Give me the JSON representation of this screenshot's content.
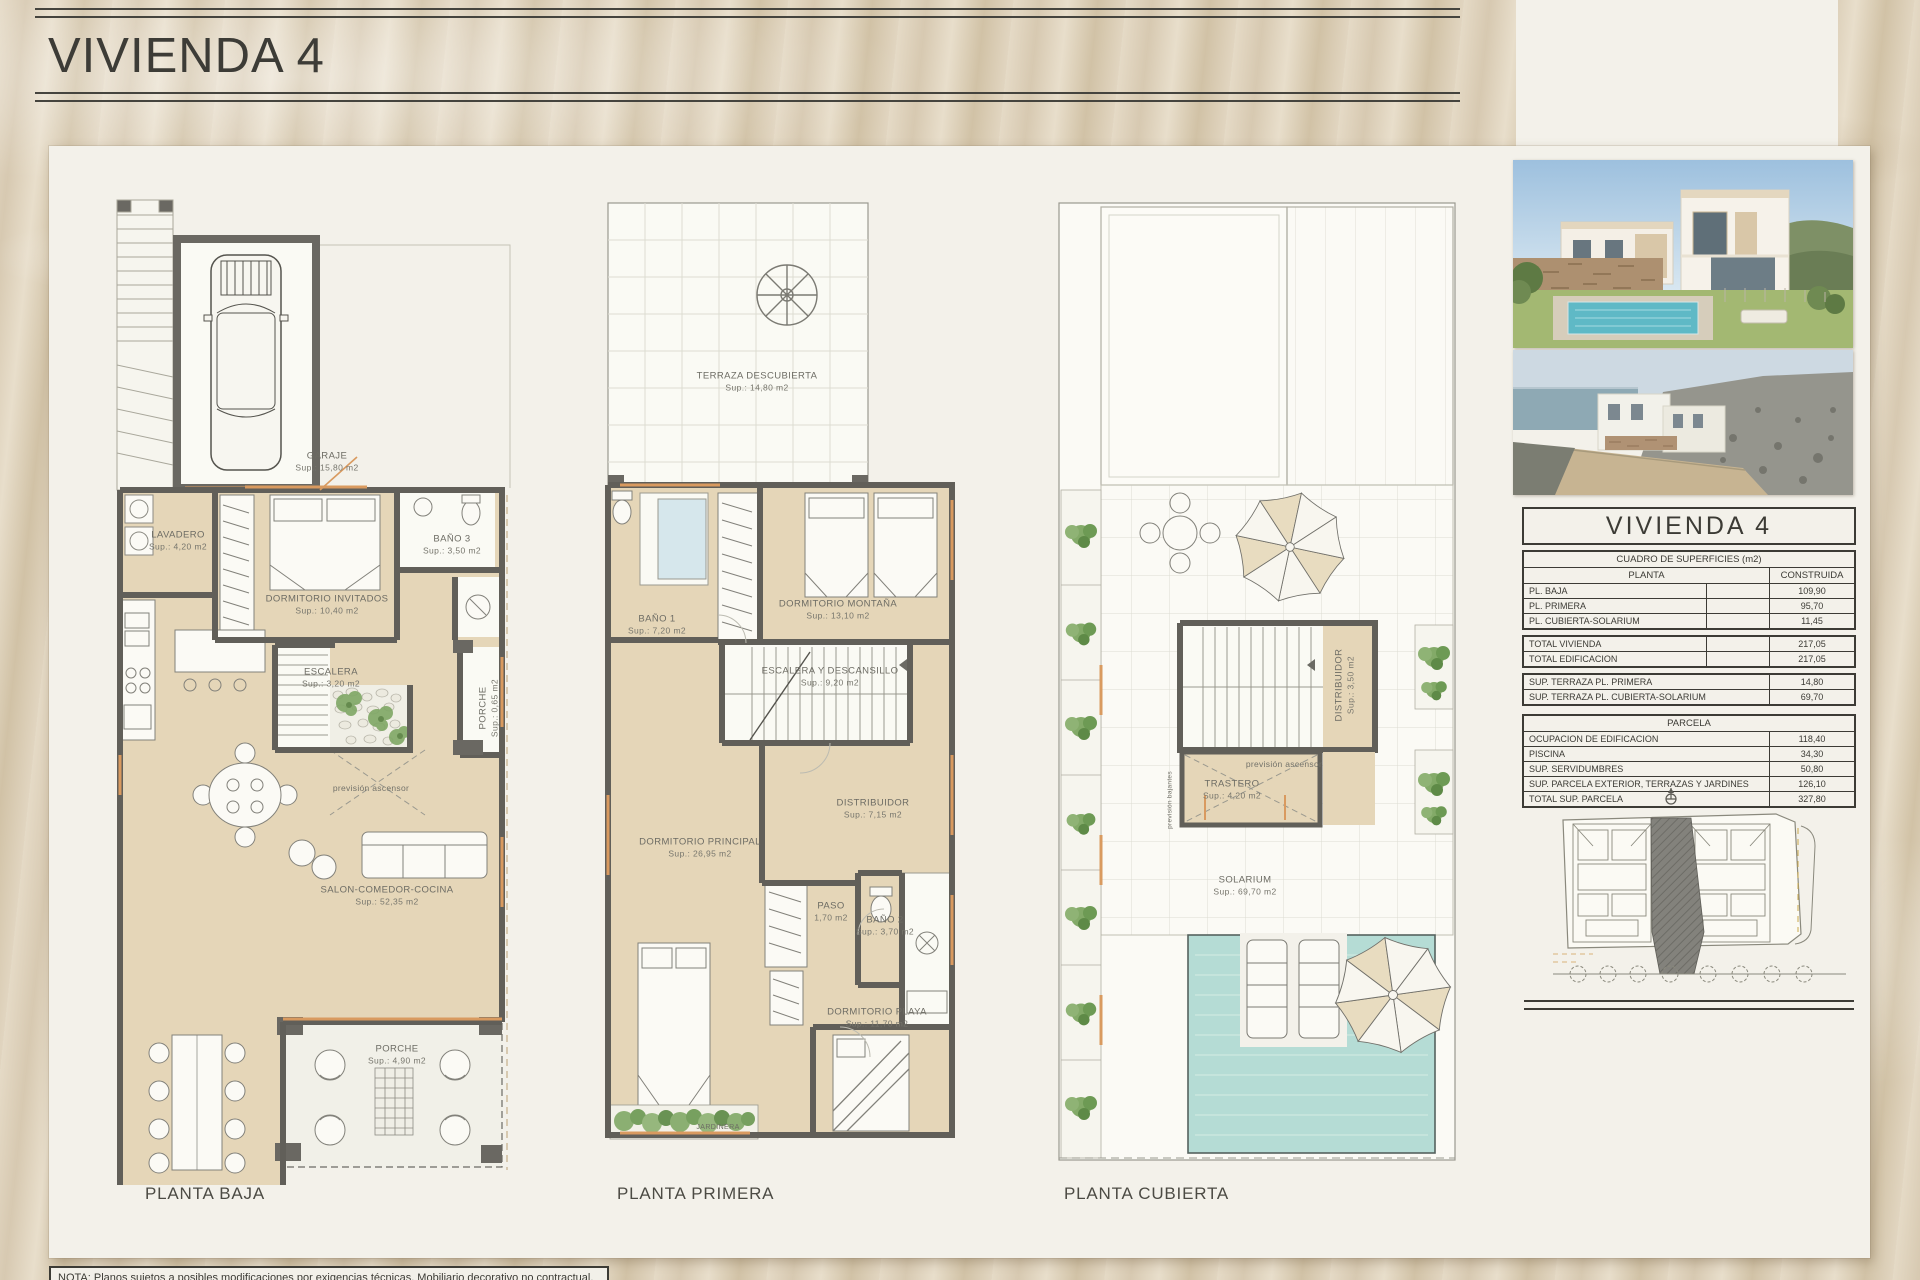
{
  "header": {
    "title": "VIVIENDA 4"
  },
  "captions": {
    "baja": "PLANTA BAJA",
    "primera": "PLANTA PRIMERA",
    "cubierta": "PLANTA CUBIERTA"
  },
  "labels": {
    "garaje": {
      "name": "GARAJE",
      "sup": "Sup.: 15,80  m2"
    },
    "lavadero": {
      "name": "LAVADERO",
      "sup": "Sup.: 4,20   m2"
    },
    "dormitorio_invitados": {
      "name": "DORMITORIO INVITADOS",
      "sup": "Sup.: 10,40  m2"
    },
    "bano3": {
      "name": "BAÑO 3",
      "sup": "Sup.: 3,50   m2"
    },
    "escalera_baja": {
      "name": "ESCALERA",
      "sup": "Sup.: 3,20   m2"
    },
    "porche_lateral": {
      "name": "PORCHE",
      "sup": "Sup.: 0,65  m2"
    },
    "salon": {
      "name": "SALON-COMEDOR-COCINA",
      "sup": "Sup.: 52,35  m2"
    },
    "porche_baja": {
      "name": "PORCHE",
      "sup": "Sup.: 4,90   m2"
    },
    "terraza_descubierta": {
      "name": "TERRAZA DESCUBIERTA",
      "sup": "Sup.: 14,80  m2"
    },
    "bano1": {
      "name": "BAÑO 1",
      "sup": "Sup.: 7,20   m2"
    },
    "dormitorio_montana": {
      "name": "DORMITORIO MONTAÑA",
      "sup": "Sup.: 13,10  m2"
    },
    "escalera_descansillo": {
      "name": "ESCALERA Y DESCANSILLO",
      "sup": "Sup.: 9,20   m2"
    },
    "dormitorio_principal": {
      "name": "DORMITORIO PRINCIPAL",
      "sup": "Sup.: 26,95  m2"
    },
    "distribuidor_primera": {
      "name": "DISTRIBUIDOR",
      "sup": "Sup.: 7,15   m2"
    },
    "paso": {
      "name": "PASO",
      "sup": "1,70 m2"
    },
    "bano2": {
      "name": "BAÑO 2",
      "sup": "Sup.: 3,70   m2"
    },
    "dormitorio_playa": {
      "name": "DORMITORIO PLAYA",
      "sup": "Sup.: 11,70  m2"
    },
    "jardinera": {
      "name": "JARDINERA"
    },
    "distribuidor_cubierta": {
      "name": "DISTRIBUIDOR",
      "sup": "Sup.: 3,50  m2"
    },
    "trastero": {
      "name": "TRASTERO",
      "sup": "Sup.: 4,20   m2"
    },
    "solarium": {
      "name": "SOLARIUM",
      "sup": "Sup.: 69,70  m2"
    },
    "prevision_ascensor": "previsión ascensor",
    "prevision_bajantes": "previsión bajantes"
  },
  "table": {
    "title": "VIVIENDA 4",
    "surfaces": {
      "header": "CUADRO DE SUPERFICIES (m2)",
      "col_left": "PLANTA",
      "col_right": "CONSTRUIDA",
      "rows": [
        {
          "label": "PL. BAJA",
          "value": "109,90"
        },
        {
          "label": "PL. PRIMERA",
          "value": "95,70"
        },
        {
          "label": "PL. CUBIERTA-SOLARIUM",
          "value": "11,45"
        }
      ]
    },
    "totals": {
      "rows": [
        {
          "label": "TOTAL VIVIENDA",
          "value": "217,05"
        },
        {
          "label": "TOTAL EDIFICACION",
          "value": "217,05"
        }
      ]
    },
    "terrazas": {
      "rows": [
        {
          "label": "SUP. TERRAZA PL. PRIMERA",
          "value": "14,80"
        },
        {
          "label": "SUP. TERRAZA PL. CUBIERTA-SOLARIUM",
          "value": "69,70"
        }
      ]
    },
    "parcela": {
      "header": "PARCELA",
      "rows": [
        {
          "label": "OCUPACION DE EDIFICACION",
          "value": "118,40"
        },
        {
          "label": "PISCINA",
          "value": "34,30"
        },
        {
          "label": "SUP. SERVIDUMBRES",
          "value": "50,80"
        },
        {
          "label": "SUP. PARCELA EXTERIOR, TERRAZAS Y JARDINES",
          "value": "126,10"
        },
        {
          "label": "TOTAL SUP. PARCELA",
          "value": "327,80"
        }
      ]
    }
  },
  "note": {
    "text": "NOTA: Planos sujetos a posibles modificaciones por exigencias técnicas. Mobiliario decorativo no contractual."
  }
}
